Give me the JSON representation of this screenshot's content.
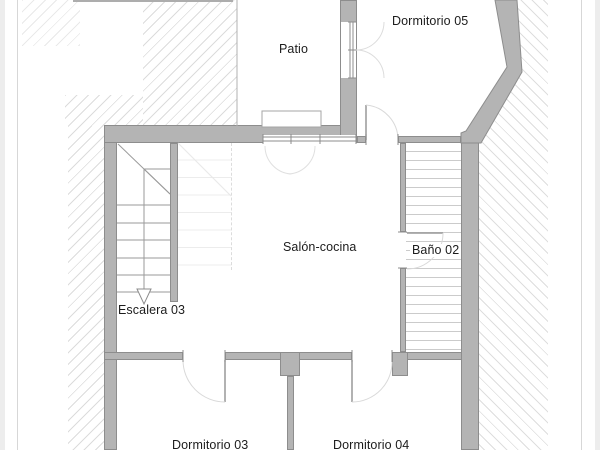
{
  "rooms": {
    "patio": {
      "label": "Patio"
    },
    "dormitorio05": {
      "label": "Dormitorio 05"
    },
    "salonCocina": {
      "label": "Salón-cocina"
    },
    "bano02": {
      "label": "Baño 02"
    },
    "escalera03": {
      "label": "Escalera 03"
    },
    "dormitorio03": {
      "label": "Dormitorio 03"
    },
    "dormitorio04": {
      "label": "Dormitorio 04"
    }
  },
  "colors": {
    "wall_fill": "#b4b4b4",
    "wall_edge": "#8d8d8d",
    "hatch_line": "#dcdcdc",
    "tile_line": "#cbcbcb",
    "stair_line": "#9a9a9a",
    "door_arc": "#d9d9d9",
    "text": "#1c1c1c",
    "sheet_border": "#d7d7d7",
    "background": "#ffffff"
  }
}
